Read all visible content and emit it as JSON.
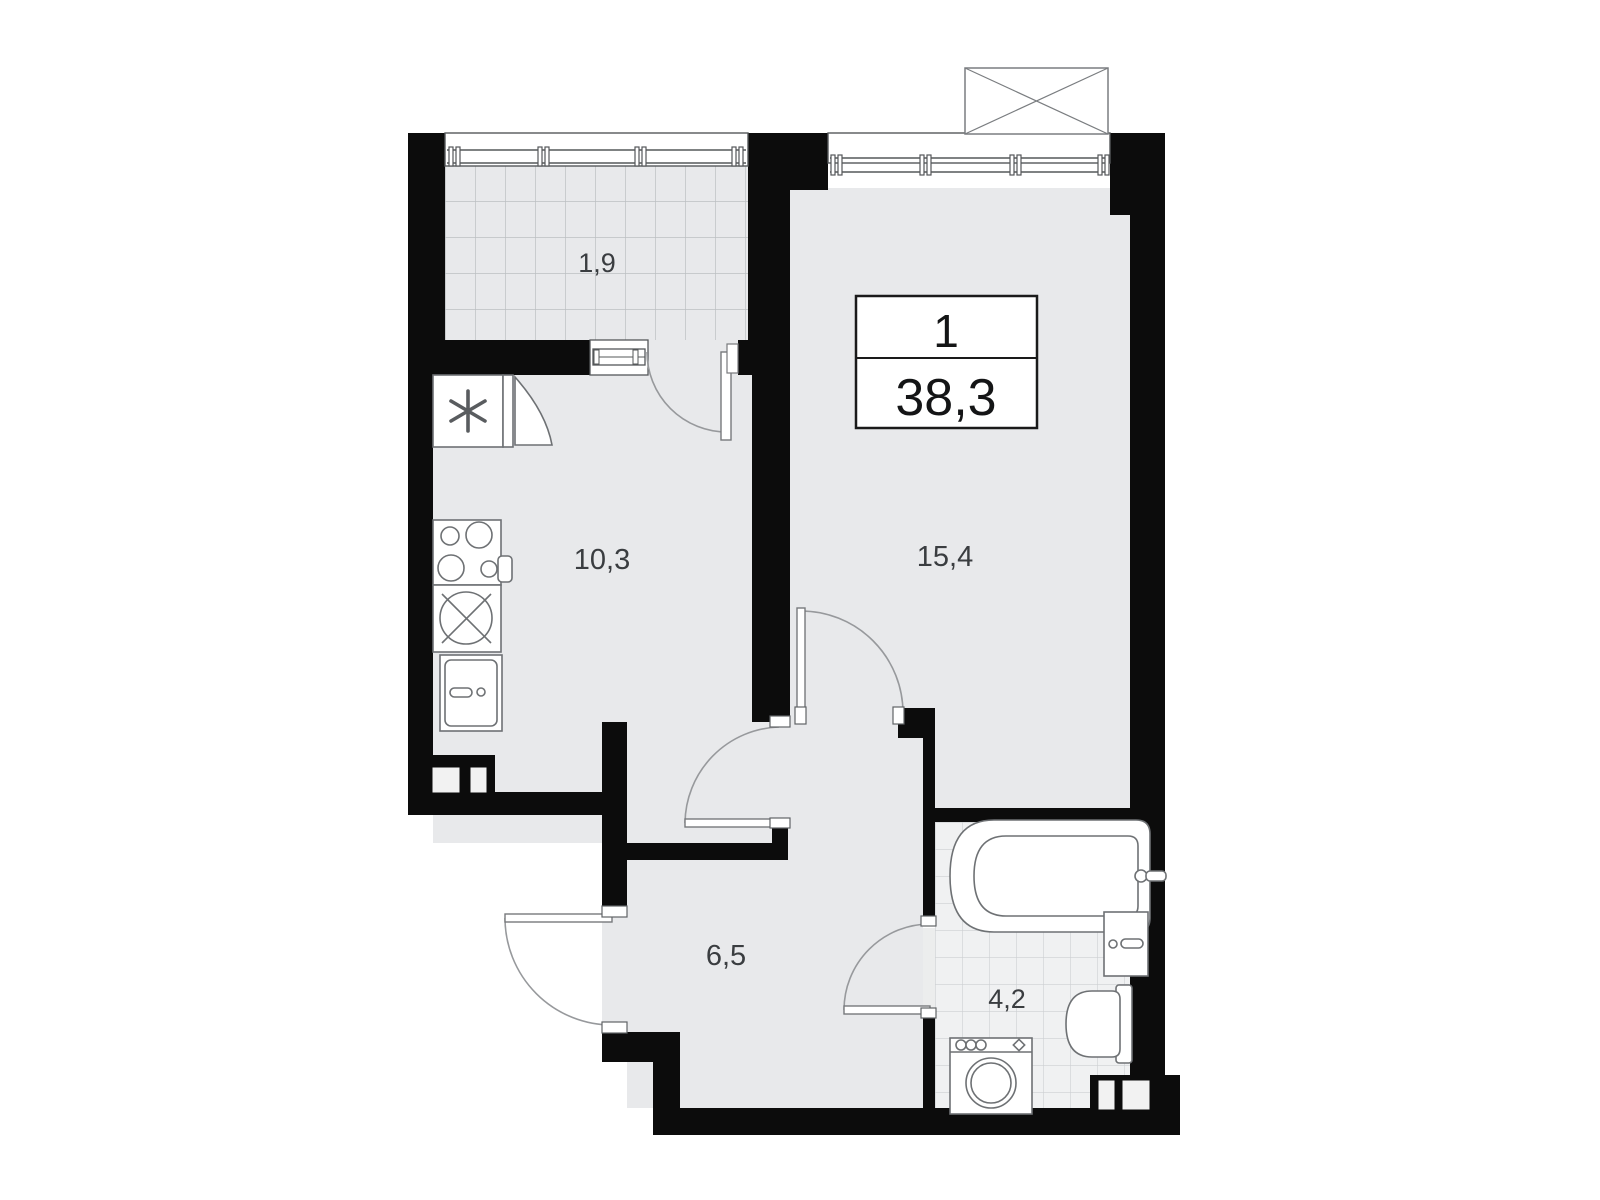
{
  "plan": {
    "info_box": {
      "rooms_count": "1",
      "total_area": "38,3"
    },
    "rooms": [
      {
        "id": "balcony",
        "area": "1,9"
      },
      {
        "id": "kitchen",
        "area": "10,3"
      },
      {
        "id": "living",
        "area": "15,4"
      },
      {
        "id": "hallway",
        "area": "6,5"
      },
      {
        "id": "bathroom",
        "area": "4,2"
      }
    ],
    "colors": {
      "wall": "#0c0c0c",
      "floor": "#e8e9eb",
      "bath_floor": "#f0f1f2",
      "fixture_stroke": "#6e7174",
      "swing_stroke": "#97999c"
    }
  }
}
